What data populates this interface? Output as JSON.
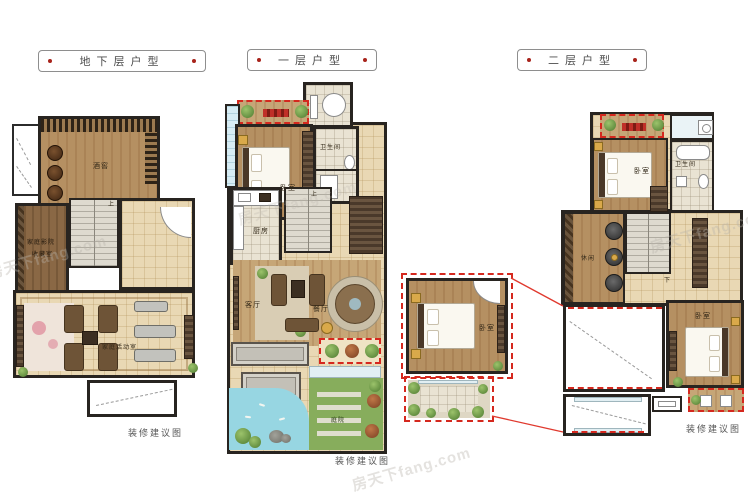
{
  "watermark": {
    "text": "房天下fang.com"
  },
  "plans": {
    "basement": {
      "title": "地下层户型",
      "caption": "装修建议图",
      "rooms": {
        "wine_cellar": "酒窖",
        "cinema_line1": "家庭影院",
        "cinema_line2": "收藏室",
        "activity_room": "家庭活动室"
      },
      "stair_marker": "上"
    },
    "floor1": {
      "title": "一层户型",
      "caption": "装修建议图",
      "rooms": {
        "bedroom": "卧室",
        "bathroom": "卫生间",
        "kitchen": "厨房",
        "living": "客厅",
        "dining": "餐厅",
        "courtyard": "庭院"
      },
      "stair_marker": "上"
    },
    "floor2": {
      "title": "二层户型",
      "caption": "装修建议图",
      "rooms": {
        "bedroom_main": "卧室",
        "bathroom": "卫生间",
        "leisure": "休闲",
        "bedroom_second": "卧室"
      },
      "stair_marker": "下"
    },
    "inset": {
      "rooms": {
        "bedroom": "卧室"
      }
    }
  },
  "colors": {
    "accent_red": "#d5281e",
    "wall_dark": "#282420",
    "wood_brown": "#b08a5f",
    "tile_cream": "#e9d8b4",
    "water_blue": "#97d6e2",
    "garden_green": "#87ad5c"
  }
}
